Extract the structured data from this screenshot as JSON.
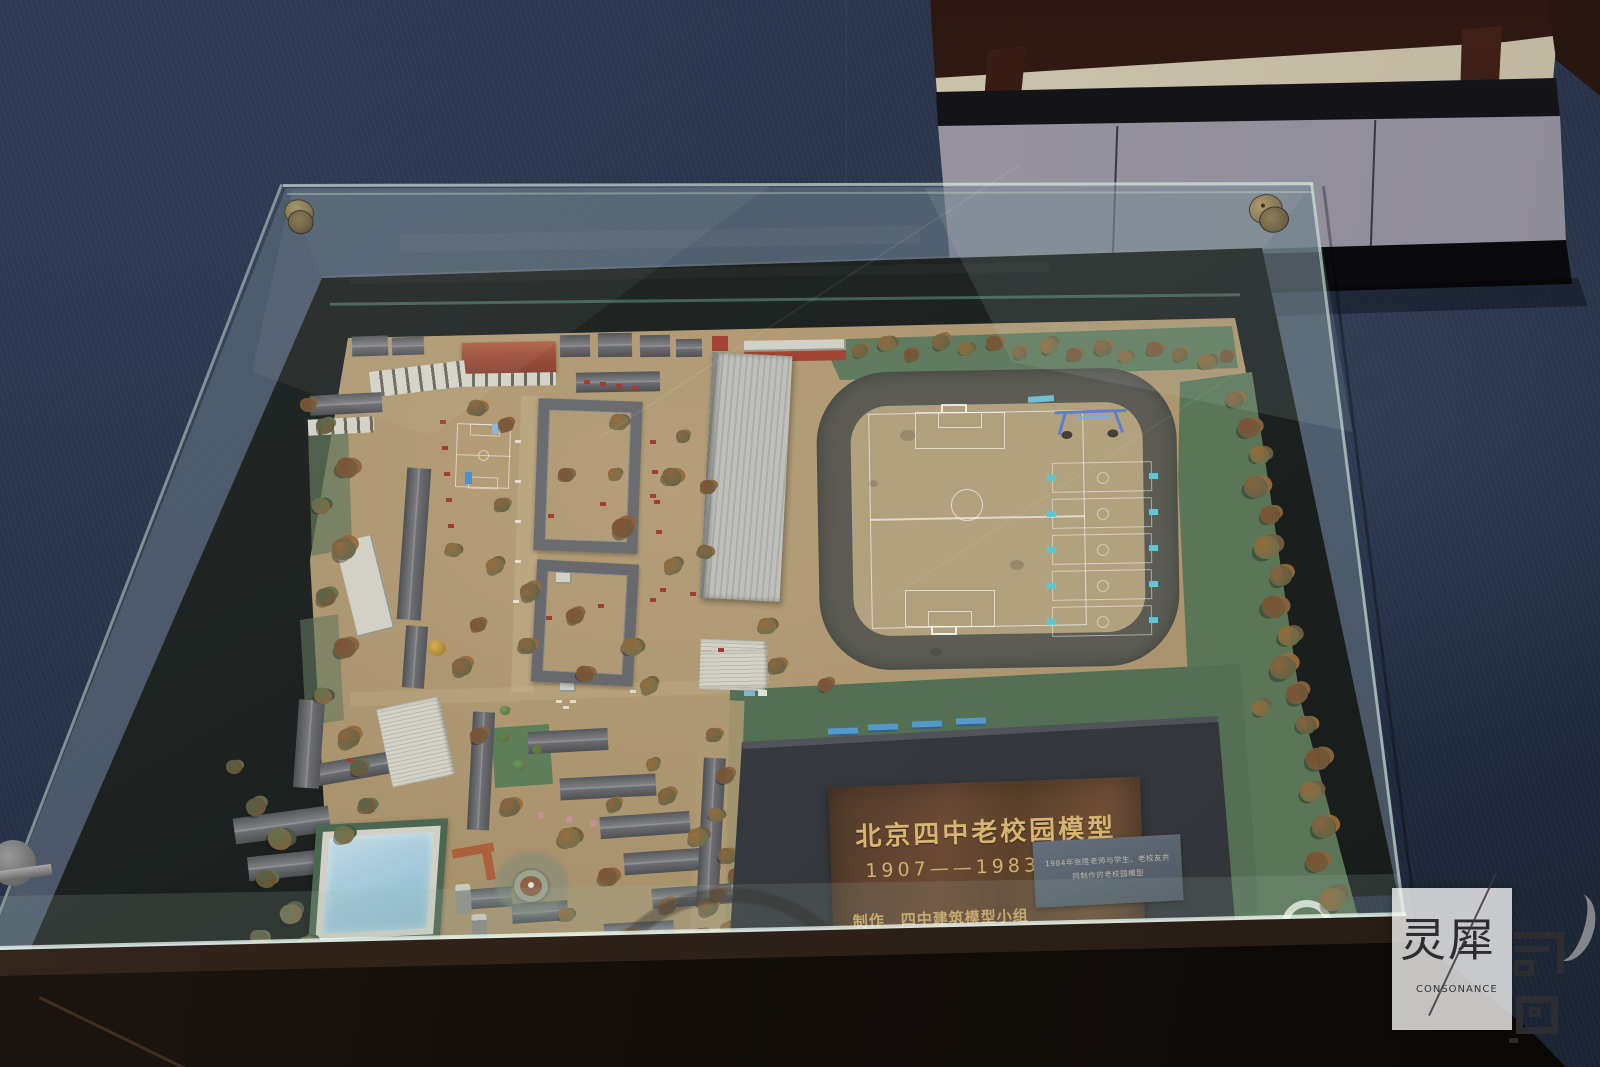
{
  "plaque": {
    "title": "北京四中老校园模型",
    "years": "1907——1983",
    "maker": "制作　四中建筑模型小组",
    "credit_line1": "指导老师　张 陞　　学生　张雪松　王延新　张 文",
    "credit_line2": "辅导校友　徐叔怀　　　　 贾晓颖　吴 镝　李 超",
    "credit_line3": "丛 军　王 雪",
    "photo_label": "1984年张陞老师与学生、老校友共同制作的老校园模型"
  },
  "watermark": {
    "name_cn": "灵犀",
    "name_en": "CONSONANCE"
  }
}
